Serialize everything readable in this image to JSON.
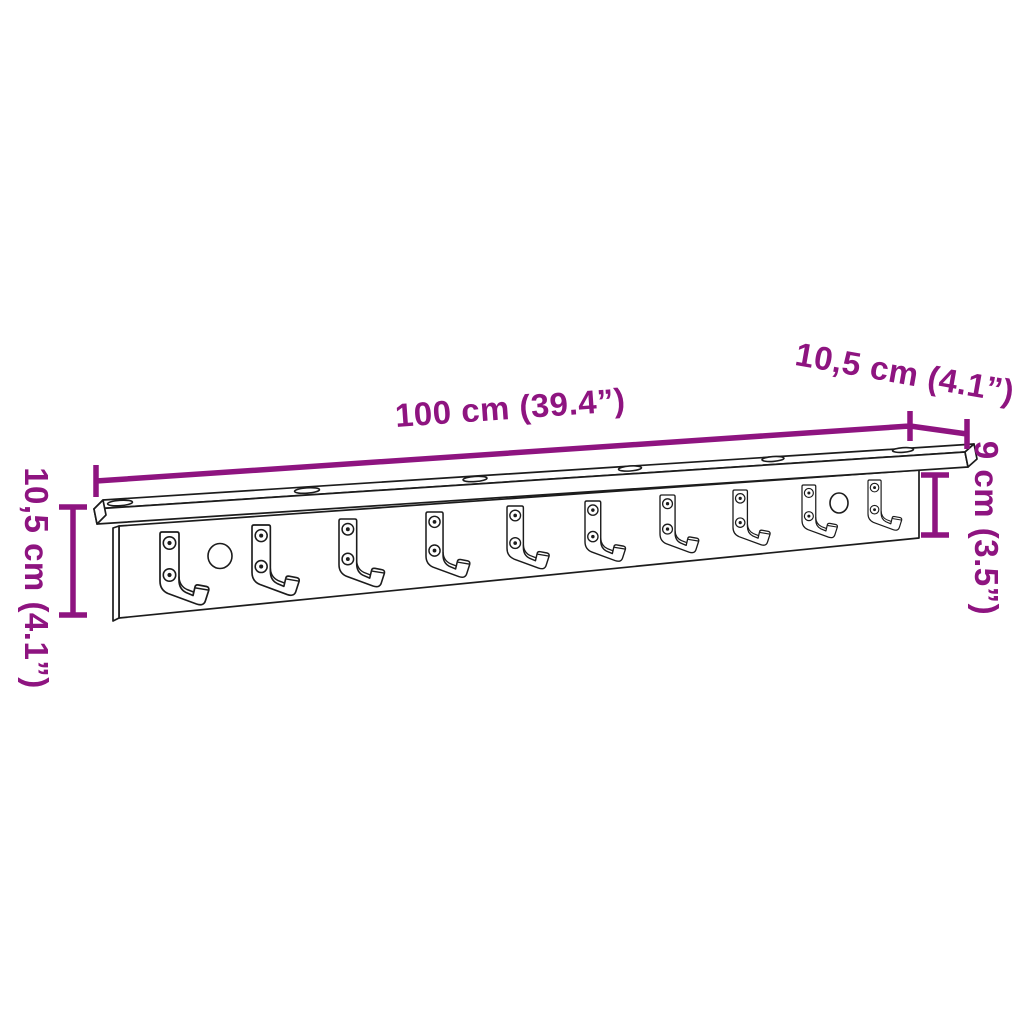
{
  "diagram": {
    "type": "product-dimension-diagram",
    "product_description": "wall-mounted coat rack with top shelf and row of hooks",
    "background_color": "#ffffff",
    "accent_color": "#8E1480",
    "line_color": "#1c1c1c",
    "labels": {
      "width": "100 cm (39.4”)",
      "depth": "10,5 cm (4.1”)",
      "height_total_left": "10,5 cm (4.1”)",
      "height_board_right": "9 cm (3.5”)"
    },
    "features": {
      "hook_count": 10,
      "mount_hole_count": 2,
      "shelf_screw_slot_count": 6
    }
  }
}
